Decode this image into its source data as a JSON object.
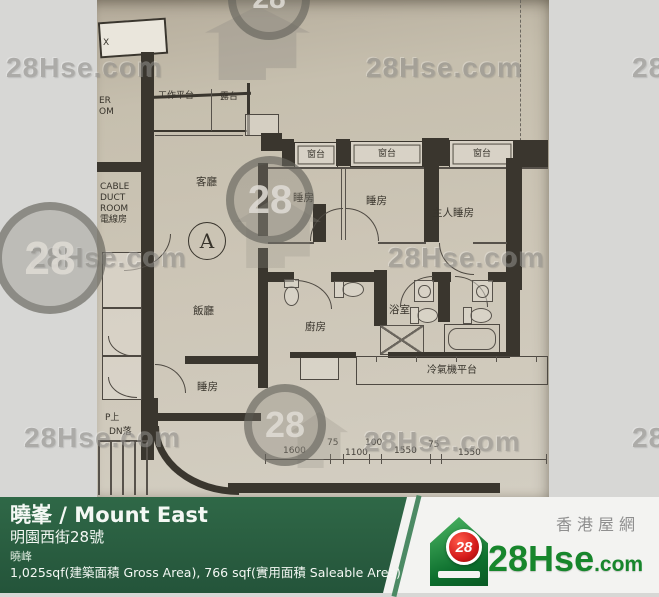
{
  "watermark": {
    "text": "28Hse.com",
    "logo_number": "28"
  },
  "plan": {
    "unit_label": "A",
    "rooms": {
      "work_platform": "工作平台",
      "balcony": "露台",
      "living_room": "客廳",
      "dining_room": "飯廳",
      "bedroom": "睡房",
      "master_bedroom": "主人睡房",
      "kitchen": "廚房",
      "bathroom": "浴室",
      "bay_window": "窗台",
      "ac_platform": "冷氣機平台"
    },
    "cable_duct_room": {
      "line1": "CABLE",
      "line2": "DUCT",
      "line3": "ROOM",
      "line4": "電線房"
    },
    "edge_text": {
      "line1": "ER",
      "line2": "OM",
      "corner": "X"
    },
    "stairs": {
      "up": "P上",
      "down": "DN落"
    },
    "dimensions": [
      "1600",
      "75",
      "1100",
      "100",
      "1550",
      "75",
      "1550"
    ]
  },
  "footer": {
    "title": "曉峯 / Mount East",
    "address": "明園西街28號",
    "estate": "曉峰",
    "area": "1,025sqf(建築面積 Gross Area), 766 sqf(實用面積 Saleable Area)"
  },
  "brand": {
    "site_zh": "香港屋網",
    "site_name": "28Hse",
    "site_tld": ".com",
    "logo_number": "28"
  }
}
